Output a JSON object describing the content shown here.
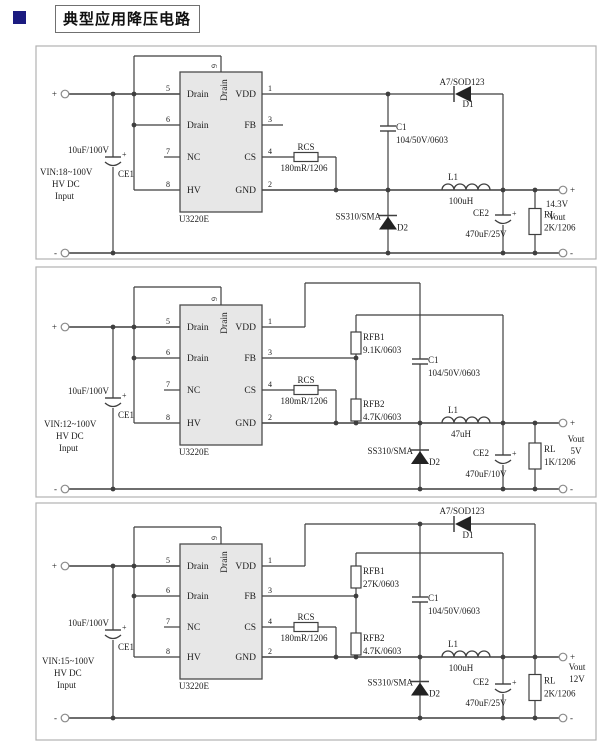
{
  "page": {
    "title": "典型应用降压电路"
  },
  "labels": {
    "in_pos": "+",
    "in_neg": "-",
    "out_pos": "+",
    "out_neg": "-",
    "plus": "+"
  },
  "ic": {
    "name": "U3220E",
    "left_pins": [
      {
        "num": "5",
        "label": "Drain"
      },
      {
        "num": "6",
        "label": "Drain"
      },
      {
        "num": "7",
        "label": "NC"
      },
      {
        "num": "8",
        "label": "HV"
      }
    ],
    "right_pins": [
      {
        "num": "1",
        "label": "VDD"
      },
      {
        "num": "3",
        "label": "FB"
      },
      {
        "num": "4",
        "label": "CS"
      },
      {
        "num": "2",
        "label": "GND"
      }
    ],
    "top_pin": {
      "num": "9",
      "label": "Drain"
    }
  },
  "circuits": [
    {
      "id": "buck-14v3",
      "vin": [
        "VIN:18~100V",
        "HV DC",
        "Input"
      ],
      "ce1": {
        "ref": "CE1",
        "value": "10uF/100V"
      },
      "rcs": {
        "ref": "RCS",
        "value": "180mR/1206"
      },
      "c1": {
        "ref": "C1",
        "value": "104/50V/0603"
      },
      "d1": {
        "ref": "D1",
        "part": "A7/SOD123"
      },
      "d2": {
        "ref": "D2",
        "part": "SS310/SMA"
      },
      "l1": {
        "ref": "L1",
        "value": "100uH"
      },
      "ce2": {
        "ref": "CE2",
        "value": "470uF/25V"
      },
      "rl": {
        "ref": "RL",
        "value": "2K/1206"
      },
      "vout": [
        "14.3V",
        "Vout"
      ]
    },
    {
      "id": "buck-5v",
      "vin": [
        "VIN:12~100V",
        "HV DC",
        "Input"
      ],
      "ce1": {
        "ref": "CE1",
        "value": "10uF/100V"
      },
      "rcs": {
        "ref": "RCS",
        "value": "180mR/1206"
      },
      "rfb1": {
        "ref": "RFB1",
        "value": "9.1K/0603"
      },
      "rfb2": {
        "ref": "RFB2",
        "value": "4.7K/0603"
      },
      "c1": {
        "ref": "C1",
        "value": "104/50V/0603"
      },
      "d2": {
        "ref": "D2",
        "part": "SS310/SMA"
      },
      "l1": {
        "ref": "L1",
        "value": "47uH"
      },
      "ce2": {
        "ref": "CE2",
        "value": "470uF/10V"
      },
      "rl": {
        "ref": "RL",
        "value": "1K/1206"
      },
      "vout": [
        "Vout",
        "5V"
      ]
    },
    {
      "id": "buck-12v",
      "vin": [
        "VIN:15~100V",
        "HV DC",
        "Input"
      ],
      "ce1": {
        "ref": "CE1",
        "value": "10uF/100V"
      },
      "rcs": {
        "ref": "RCS",
        "value": "180mR/1206"
      },
      "rfb1": {
        "ref": "RFB1",
        "value": "27K/0603"
      },
      "rfb2": {
        "ref": "RFB2",
        "value": "4.7K/0603"
      },
      "c1": {
        "ref": "C1",
        "value": "104/50V/0603"
      },
      "d1": {
        "ref": "D1",
        "part": "A7/SOD123"
      },
      "d2": {
        "ref": "D2",
        "part": "SS310/SMA"
      },
      "l1": {
        "ref": "L1",
        "value": "100uH"
      },
      "ce2": {
        "ref": "CE2",
        "value": "470uF/25V"
      },
      "rl": {
        "ref": "RL",
        "value": "2K/1206"
      },
      "vout": [
        "Vout",
        "12V"
      ]
    }
  ],
  "colors": {
    "wire": "#3f3f3f",
    "ic_fill": "#e7e7e7",
    "frame": "#b2b2b2",
    "bullet": "#1b1b80"
  }
}
